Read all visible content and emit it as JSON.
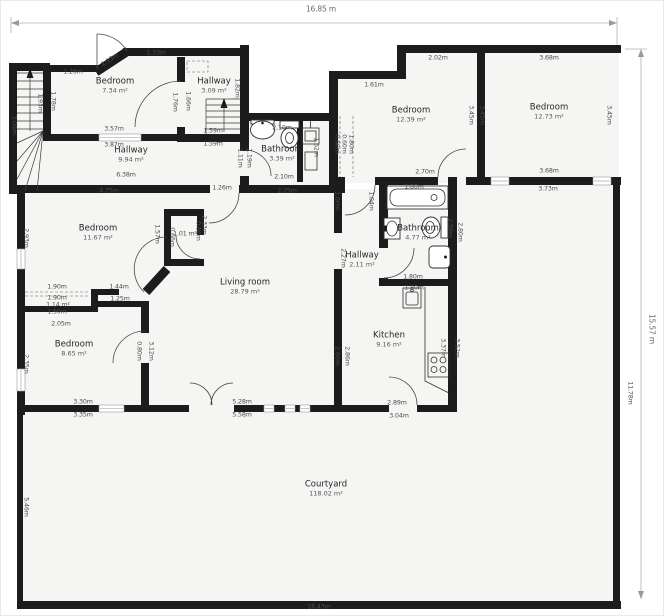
{
  "colors": {
    "wall": "#1c1c1c",
    "floor": "#f5f5f4",
    "dim_text": "#4b4b4b",
    "room_text": "#262626",
    "dim_line": "#b3b3b3",
    "background": "#ffffff"
  },
  "plan": {
    "overall": {
      "width": "16.85 m",
      "height": "15.57 m",
      "bottom_width": "16.43m"
    },
    "rooms": [
      {
        "name": "Bedroom",
        "area": "7.34 m²",
        "x": 114,
        "y": 85
      },
      {
        "name": "Hallway",
        "area": "3.09 m²",
        "x": 213,
        "y": 85
      },
      {
        "name": "Hallway",
        "area": "9.94 m²",
        "x": 130,
        "y": 154
      },
      {
        "name": "Bathroom",
        "area": "3.39 m²",
        "x": 281,
        "y": 153
      },
      {
        "name": "Bedroom",
        "area": "12.39 m²",
        "x": 410,
        "y": 114
      },
      {
        "name": "Bedroom",
        "area": "12.73 m²",
        "x": 548,
        "y": 111
      },
      {
        "name": "Bedroom",
        "area": "11.67 m²",
        "x": 97,
        "y": 232
      },
      {
        "name": "Living room",
        "area": "28.79 m²",
        "x": 244,
        "y": 286
      },
      {
        "name": "Hallway",
        "area": "2.11 m²",
        "x": 361,
        "y": 259
      },
      {
        "name": "Bathroom",
        "area": "4.77 m²",
        "x": 417,
        "y": 232
      },
      {
        "name": "Bedroom",
        "area": "8.65 m²",
        "x": 73,
        "y": 348
      },
      {
        "name": "Kitchen",
        "area": "9.16 m²",
        "x": 388,
        "y": 339
      },
      {
        "name": "Courtyard",
        "area": "118.02 m²",
        "x": 325,
        "y": 488
      }
    ],
    "dims": [
      {
        "t": "16.85 m",
        "x": 320,
        "y": 8,
        "big": 1
      },
      {
        "t": "15.57 m",
        "x": 651,
        "y": 328,
        "r": 90,
        "big": 1
      },
      {
        "t": "16.43m",
        "x": 318,
        "y": 606
      },
      {
        "t": "11.78m",
        "x": 629,
        "y": 392,
        "r": 90
      },
      {
        "t": "5.46m",
        "x": 25,
        "y": 506,
        "r": 90
      },
      {
        "t": "1.26m",
        "x": 72,
        "y": 71
      },
      {
        "t": "1.13m",
        "x": 109,
        "y": 59,
        "r": -33
      },
      {
        "t": "1.33m",
        "x": 155,
        "y": 52
      },
      {
        "t": "1.93m",
        "x": 39,
        "y": 102,
        "r": 90
      },
      {
        "t": "3.06m",
        "x": 13,
        "y": 124,
        "r": 90
      },
      {
        "t": "1.78m",
        "x": 52,
        "y": 100,
        "r": 90
      },
      {
        "t": "3.57m",
        "x": 113,
        "y": 128
      },
      {
        "t": "3.87m",
        "x": 113,
        "y": 144
      },
      {
        "t": "1.66m",
        "x": 187,
        "y": 100,
        "r": 90
      },
      {
        "t": "1.76m",
        "x": 174,
        "y": 101,
        "r": 90
      },
      {
        "t": "1.82m",
        "x": 236,
        "y": 87,
        "r": 90
      },
      {
        "t": "1.59m",
        "x": 212,
        "y": 130
      },
      {
        "t": "1.59m",
        "x": 212,
        "y": 143
      },
      {
        "t": "6.38m",
        "x": 125,
        "y": 174
      },
      {
        "t": "4.75m",
        "x": 108,
        "y": 190
      },
      {
        "t": "1.11m",
        "x": 239,
        "y": 157,
        "r": 90
      },
      {
        "t": "1.19m",
        "x": 248,
        "y": 157,
        "r": 90
      },
      {
        "t": "2.10m",
        "x": 281,
        "y": 127
      },
      {
        "t": "2.10m",
        "x": 283,
        "y": 176
      },
      {
        "t": "2.25m",
        "x": 286,
        "y": 190
      },
      {
        "t": "1.26m",
        "x": 221,
        "y": 187
      },
      {
        "t": "1.62m",
        "x": 315,
        "y": 146,
        "r": 90
      },
      {
        "t": "0.60m",
        "x": 336,
        "y": 143,
        "r": 90
      },
      {
        "t": "0.60m",
        "x": 343,
        "y": 143,
        "r": 90
      },
      {
        "t": "1.80m",
        "x": 350,
        "y": 143,
        "r": 90
      },
      {
        "t": "2.02m",
        "x": 437,
        "y": 57
      },
      {
        "t": "1.61m",
        "x": 373,
        "y": 84
      },
      {
        "t": "3.45m",
        "x": 470,
        "y": 114,
        "r": 90
      },
      {
        "t": "3.45m",
        "x": 481,
        "y": 114,
        "r": 90
      },
      {
        "t": "2.70m",
        "x": 424,
        "y": 171
      },
      {
        "t": "3.68m",
        "x": 548,
        "y": 57
      },
      {
        "t": "3.45m",
        "x": 608,
        "y": 114,
        "r": 90
      },
      {
        "t": "3.68m",
        "x": 548,
        "y": 170
      },
      {
        "t": "3.73m",
        "x": 547,
        "y": 188
      },
      {
        "t": "2.93m",
        "x": 25,
        "y": 237,
        "r": 90
      },
      {
        "t": "1.57m",
        "x": 156,
        "y": 233,
        "r": 90
      },
      {
        "t": "0.66m",
        "x": 171,
        "y": 236,
        "r": 90
      },
      {
        "t": "1.01 m²",
        "x": 184,
        "y": 233
      },
      {
        "t": "0.86m",
        "x": 197,
        "y": 230,
        "r": 90
      },
      {
        "t": "2.33m",
        "x": 203,
        "y": 224,
        "r": 90
      },
      {
        "t": "1.44m",
        "x": 118,
        "y": 286
      },
      {
        "t": "1.25m",
        "x": 119,
        "y": 298
      },
      {
        "t": "1.90m",
        "x": 56,
        "y": 286
      },
      {
        "t": "1.90m",
        "x": 56,
        "y": 297
      },
      {
        "t": "1.14 m²",
        "x": 57,
        "y": 304
      },
      {
        "t": "1.90m",
        "x": 56,
        "y": 311
      },
      {
        "t": "2.05m",
        "x": 60,
        "y": 323
      },
      {
        "t": "2.35m",
        "x": 25,
        "y": 363,
        "r": 90
      },
      {
        "t": "3.30m",
        "x": 82,
        "y": 401
      },
      {
        "t": "3.35m",
        "x": 82,
        "y": 414
      },
      {
        "t": "0.80m",
        "x": 138,
        "y": 350,
        "r": 90
      },
      {
        "t": "3.12m",
        "x": 150,
        "y": 350,
        "r": 90
      },
      {
        "t": "5.28m",
        "x": 241,
        "y": 401
      },
      {
        "t": "5.58m",
        "x": 241,
        "y": 414
      },
      {
        "t": "1.00m",
        "x": 336,
        "y": 200,
        "r": 90
      },
      {
        "t": "1.04m",
        "x": 370,
        "y": 200,
        "r": 90
      },
      {
        "t": "2.27m",
        "x": 342,
        "y": 257,
        "r": 90
      },
      {
        "t": "1.80m",
        "x": 413,
        "y": 186
      },
      {
        "t": "2.58m",
        "x": 449,
        "y": 227,
        "r": 90
      },
      {
        "t": "2.80m",
        "x": 459,
        "y": 231,
        "r": 90
      },
      {
        "t": "1.80m",
        "x": 412,
        "y": 276
      },
      {
        "t": "1.80m",
        "x": 413,
        "y": 287
      },
      {
        "t": "2.86m",
        "x": 336,
        "y": 355,
        "r": 90
      },
      {
        "t": "2.86m",
        "x": 346,
        "y": 355,
        "r": 90
      },
      {
        "t": "3.37m",
        "x": 442,
        "y": 347,
        "r": 90
      },
      {
        "t": "3.52m",
        "x": 456,
        "y": 347,
        "r": 90
      },
      {
        "t": "2.89m",
        "x": 396,
        "y": 402
      },
      {
        "t": "3.04m",
        "x": 398,
        "y": 415
      }
    ]
  }
}
